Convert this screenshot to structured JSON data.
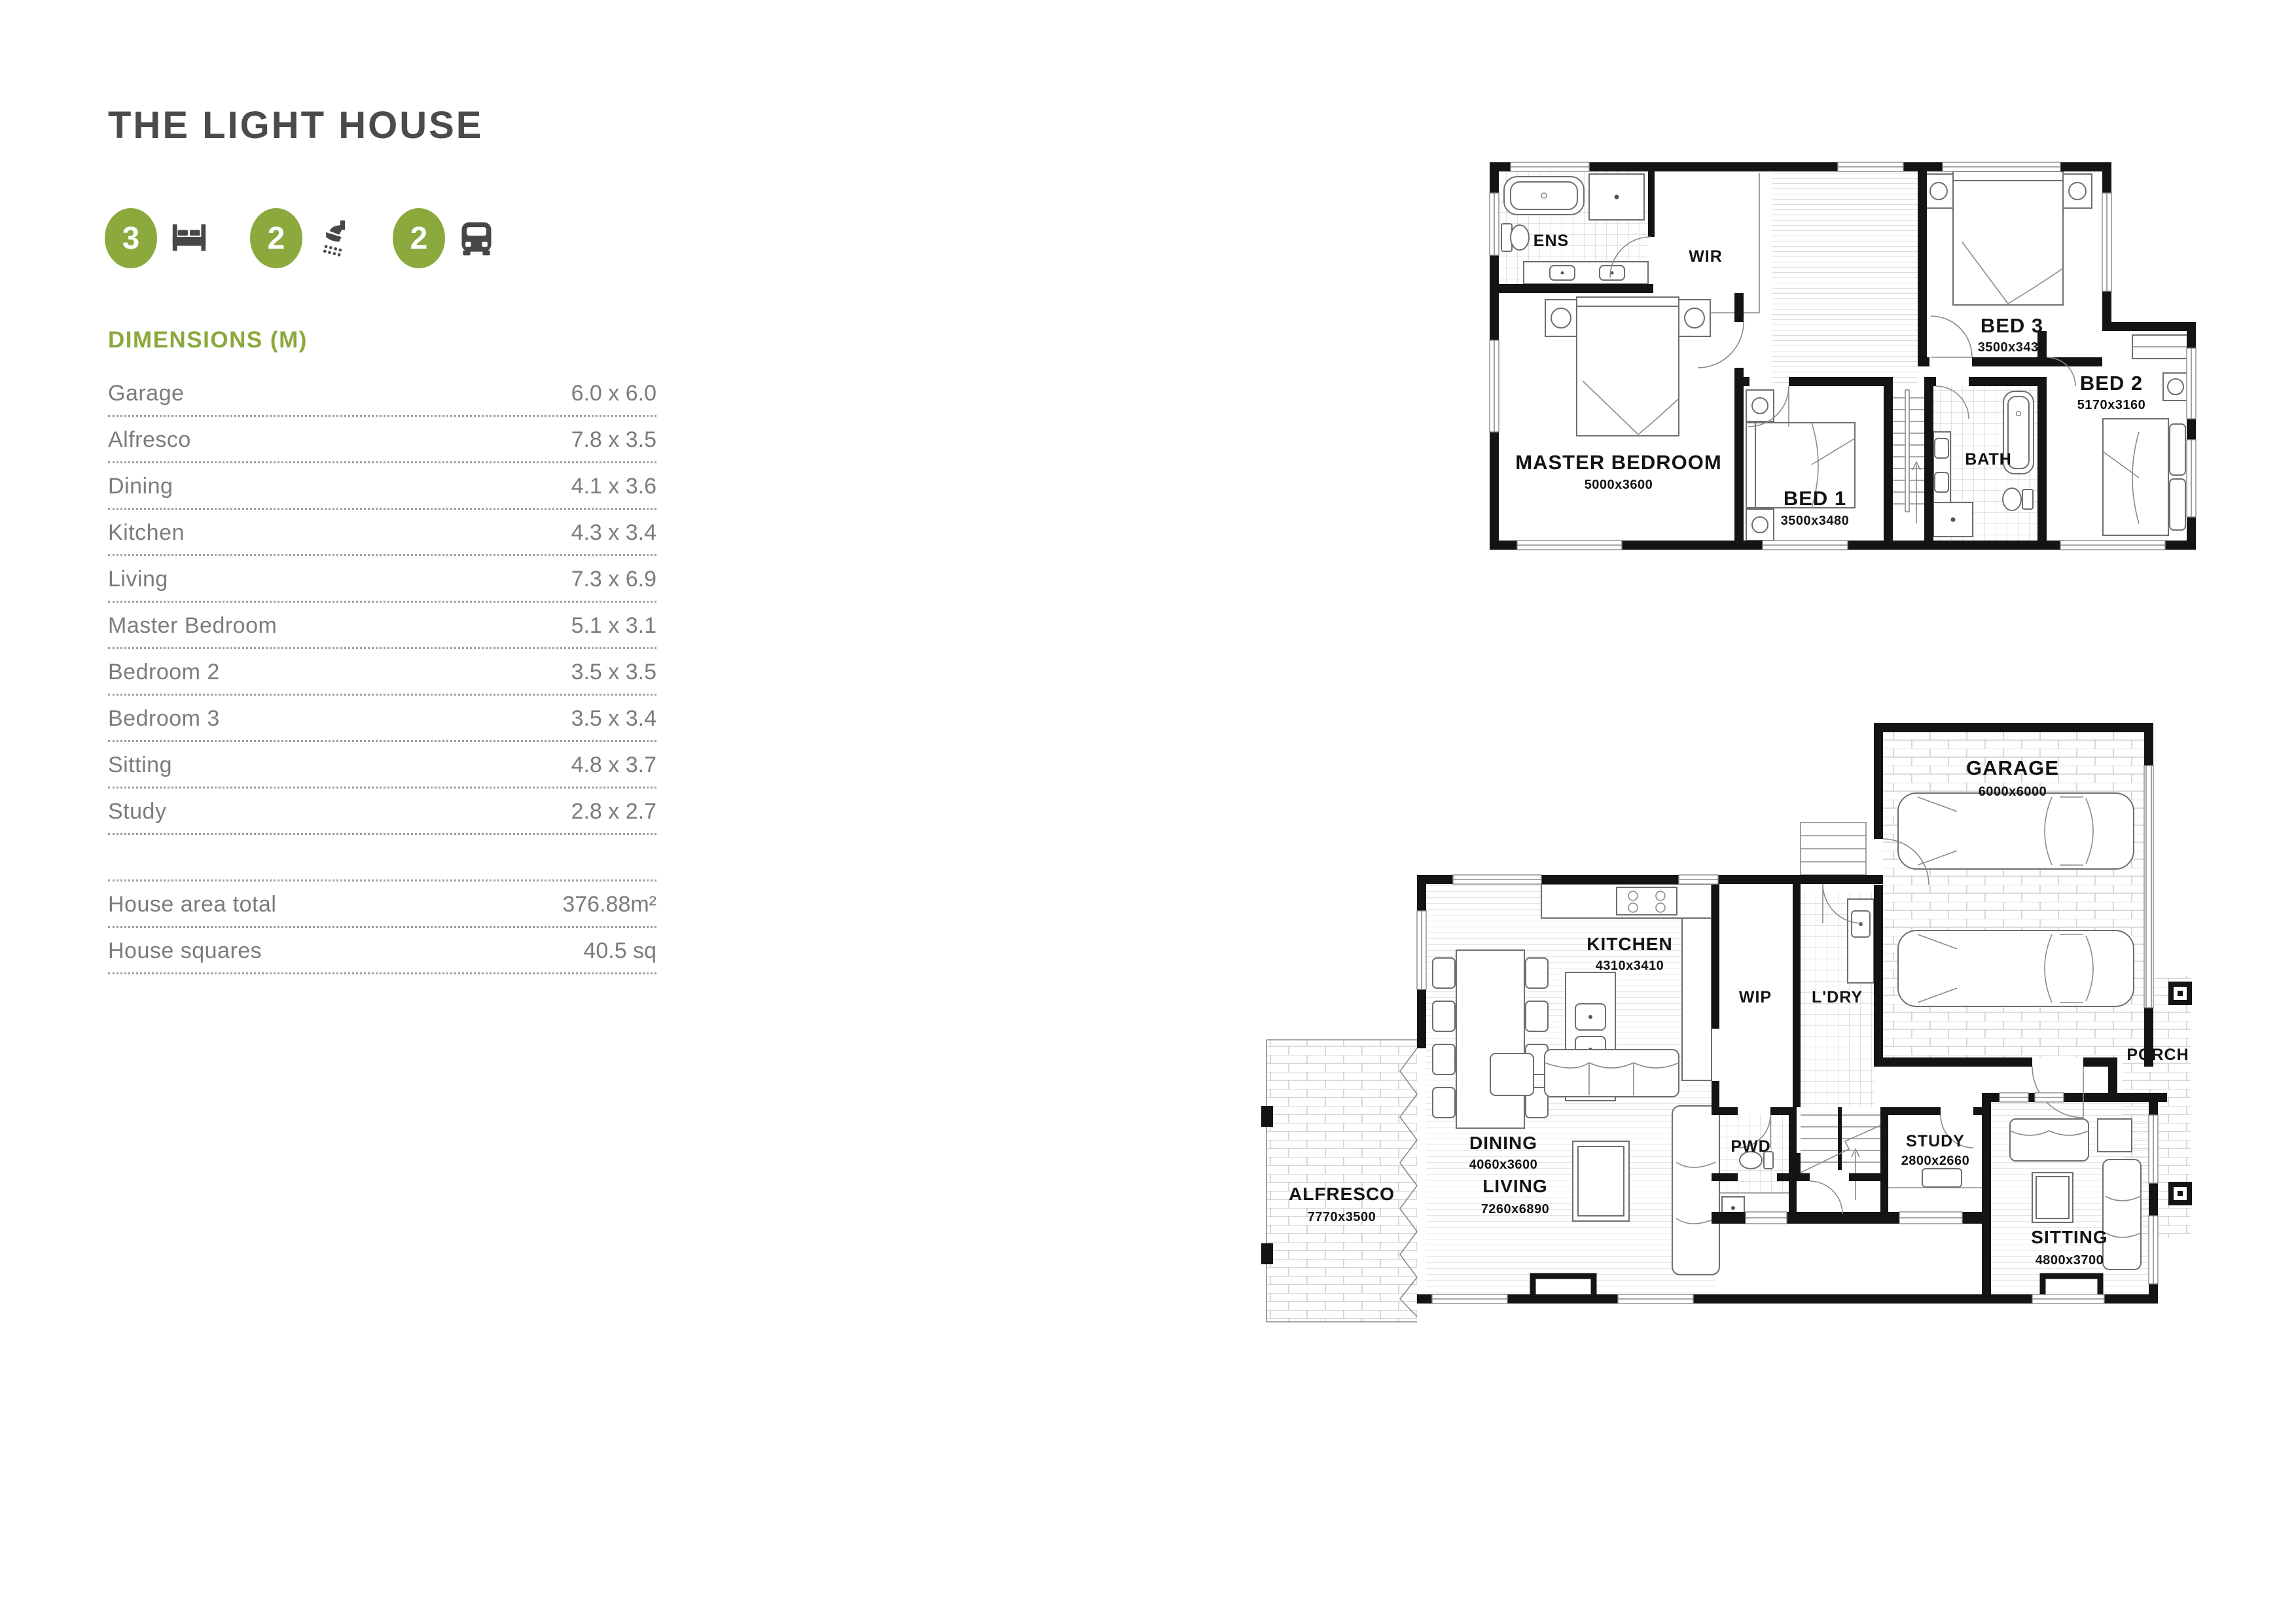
{
  "header": {
    "title": "THE LIGHT HOUSE"
  },
  "accent_color": "#8BA93C",
  "features": [
    {
      "count": "3",
      "icon": "bed-icon"
    },
    {
      "count": "2",
      "icon": "shower-icon"
    },
    {
      "count": "2",
      "icon": "car-icon"
    }
  ],
  "dimensions": {
    "heading": "DIMENSIONS (M)",
    "rows": [
      {
        "label": "Garage",
        "value": "6.0 x 6.0"
      },
      {
        "label": "Alfresco",
        "value": "7.8 x 3.5"
      },
      {
        "label": "Dining",
        "value": "4.1 x 3.6"
      },
      {
        "label": "Kitchen",
        "value": "4.3 x 3.4"
      },
      {
        "label": "Living",
        "value": "7.3 x 6.9"
      },
      {
        "label": "Master Bedroom",
        "value": "5.1 x 3.1"
      },
      {
        "label": "Bedroom 2",
        "value": "3.5 x 3.5"
      },
      {
        "label": "Bedroom 3",
        "value": "3.5 x 3.4"
      },
      {
        "label": "Sitting",
        "value": "4.8 x 3.7"
      },
      {
        "label": "Study",
        "value": "2.8 x 2.7"
      }
    ],
    "totals": [
      {
        "label": "House area total",
        "value": "376.88m²"
      },
      {
        "label": "House squares",
        "value": "40.5 sq"
      }
    ]
  },
  "upper_floor": {
    "rooms": [
      {
        "name": "ENS",
        "dim": ""
      },
      {
        "name": "WIR",
        "dim": ""
      },
      {
        "name": "MASTER BEDROOM",
        "dim": "5000x3600"
      },
      {
        "name": "BED 1",
        "dim": "3500x3480"
      },
      {
        "name": "BATH",
        "dim": ""
      },
      {
        "name": "BED 3",
        "dim": "3500x3430"
      },
      {
        "name": "BED 2",
        "dim": "5170x3160"
      }
    ]
  },
  "ground_floor": {
    "rooms": [
      {
        "name": "GARAGE",
        "dim": "6000x6000"
      },
      {
        "name": "KITCHEN",
        "dim": "4310x3410"
      },
      {
        "name": "WIP",
        "dim": ""
      },
      {
        "name": "L'DRY",
        "dim": ""
      },
      {
        "name": "DINING",
        "dim": "4060x3600"
      },
      {
        "name": "ALFRESCO",
        "dim": "7770x3500"
      },
      {
        "name": "LIVING",
        "dim": "7260x6890"
      },
      {
        "name": "PWD",
        "dim": ""
      },
      {
        "name": "STUDY",
        "dim": "2800x2660"
      },
      {
        "name": "SITTING",
        "dim": "4800x3700"
      },
      {
        "name": "PORCH",
        "dim": ""
      }
    ]
  }
}
